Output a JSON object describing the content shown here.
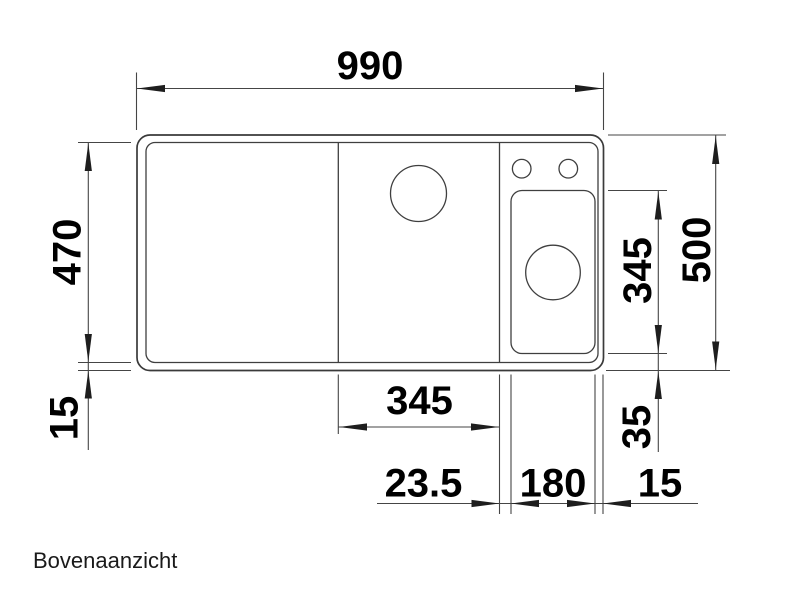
{
  "colors": {
    "line": "#3A3A3A",
    "arrow": "#1E1E1E",
    "text": "#000000",
    "background": "#FFFFFF"
  },
  "caption": "Bovenaanzicht",
  "dimensions": {
    "overall_width_mm": "990",
    "basin_depth_mm": "470",
    "front_rim_mm": "15",
    "overall_depth_mm": "500",
    "sub_bowl_depth_mm": "345",
    "rear_offset_mm": "35",
    "main_bowl_width_mm": "345",
    "bowl_spacing_mm": "23.5",
    "sub_bowl_width_mm": "180",
    "right_rim_mm": "15"
  }
}
